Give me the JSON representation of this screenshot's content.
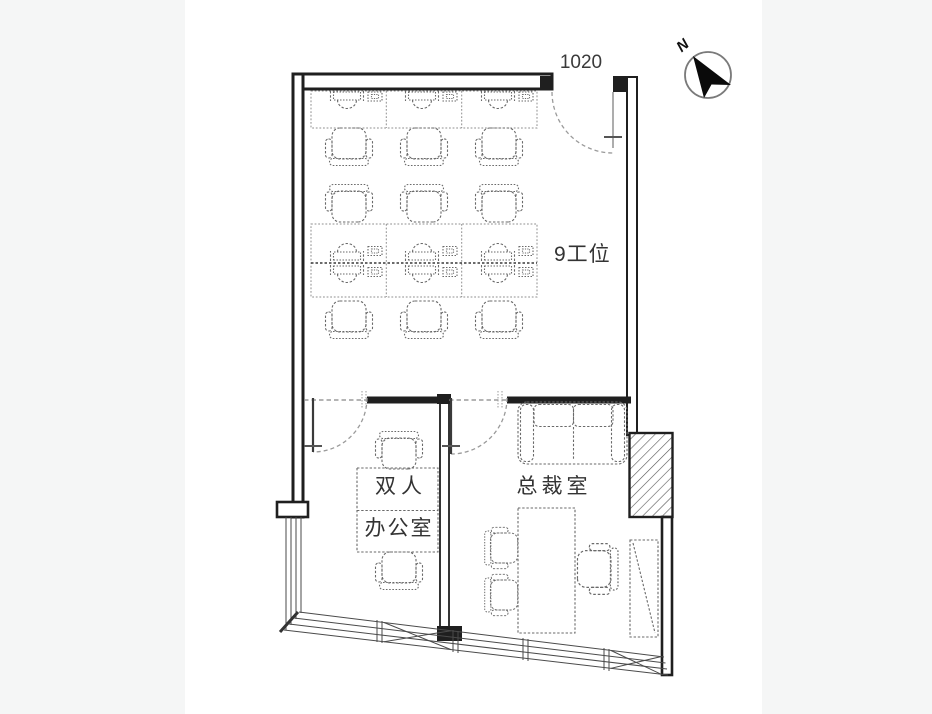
{
  "colors": {
    "canvas": "#f5f6f6",
    "page": "#ffffff",
    "wall": "#1f1f1f",
    "furniture": "#6a6a6a",
    "door": "#9a9a9a",
    "text": "#333333"
  },
  "labels": {
    "door_dimension": "1020",
    "compass_north": "N"
  },
  "rooms": {
    "open_office": {
      "name": "9工位",
      "workstation_count": 9,
      "desk_rows": 3,
      "chair_count": 9
    },
    "double_office": {
      "name_line1": "双人",
      "name_line2": "办公室",
      "desk_count": 1,
      "chair_count": 2
    },
    "ceo_office": {
      "name": "总裁室",
      "sofa_count": 1,
      "desk_count": 1,
      "executive_chair_count": 1,
      "guest_chair_count": 2,
      "wardrobe_count": 1
    }
  }
}
